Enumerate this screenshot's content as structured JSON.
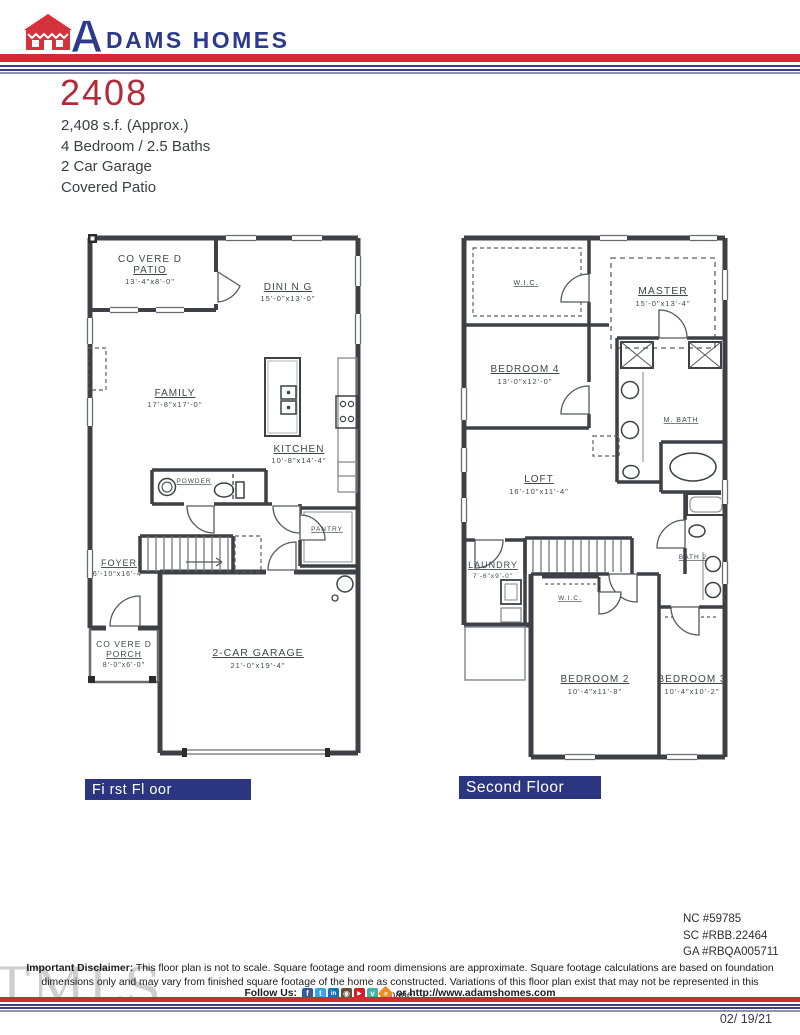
{
  "colors": {
    "accent_red": "#cf2b33",
    "brand_navy": "#2b3a8c",
    "bar_navy": "#2c3680",
    "plan_line": "#3d4145"
  },
  "header": {
    "brand_a": "A",
    "brand_rest": "DAMS HOMES"
  },
  "plan": {
    "number": "2408",
    "specs": [
      "2,408 s.f. (Approx.)",
      "4 Bedroom / 2.5 Baths",
      "2 Car Garage",
      "Covered Patio"
    ]
  },
  "floors": {
    "first": {
      "label": "Fi rst Fl oor",
      "rooms": {
        "patio": {
          "name1": "CO VERE D",
          "name2": "PATIO",
          "dims": "13'-4\"x8'-0\""
        },
        "dining": {
          "name": "DINI N G",
          "dims": "15'-0\"x13'-0\""
        },
        "family": {
          "name": "FAMILY",
          "dims": "17'-8\"x17'-0\""
        },
        "kitchen": {
          "name": "KITCHEN",
          "dims": "10'-8\"x14'-4\""
        },
        "powder": {
          "name": "POWDER"
        },
        "pantry": {
          "name": "PANTRY"
        },
        "foyer": {
          "name": "FOYER",
          "dims": "6'-10\"x16'-4\""
        },
        "porch": {
          "name1": "CO VERE D",
          "name2": "PORCH",
          "dims": "8'-0\"x6'-0\""
        },
        "garage": {
          "name": "2-CAR GARAGE",
          "dims": "21'-0\"x19'-4\""
        }
      }
    },
    "second": {
      "label": "Second Floor",
      "rooms": {
        "wic_master": {
          "name": "W.I.C."
        },
        "master": {
          "name": "MASTER",
          "dims": "15'-0\"x13'-4\""
        },
        "bedroom4": {
          "name": "BEDROOM 4",
          "dims": "13'-0\"x12'-0\""
        },
        "mbath": {
          "name": "M. BATH"
        },
        "loft": {
          "name": "LOFT",
          "dims": "16'-10\"x11'-4\""
        },
        "laundry": {
          "name": "LAUNDRY",
          "dims": "7'-6\"x9'-0\""
        },
        "wic2": {
          "name": "W.I.C."
        },
        "bath2": {
          "name": "BATH 2"
        },
        "bedroom2": {
          "name": "BEDROOM 2",
          "dims": "10'-4\"x11'-8\""
        },
        "bedroom3": {
          "name": "BEDROOM 3",
          "dims": "10'-4\"x10'-2\""
        }
      }
    }
  },
  "footer": {
    "licenses": [
      "NC #59785",
      "SC #RBB.22464",
      "GA #RBQA005711"
    ],
    "disclaimer_bold": "Important Disclaimer:",
    "disclaimer_text": "This floor plan is not to scale. Square footage and room dimensions are approximate. Square footage calculations are based on foundation dimensions only and may vary from finished square footage of the home as constructed. Variations of this floor plan exist that may not be represented in this image.",
    "follow_label": "Follow Us:",
    "follow_suffix": "or http://www.adamshomes.com",
    "social": [
      {
        "name": "facebook",
        "glyph": "f",
        "color": "#3b5998"
      },
      {
        "name": "twitter",
        "glyph": "t",
        "color": "#35a6de"
      },
      {
        "name": "linkedin",
        "glyph": "in",
        "color": "#1178b3"
      },
      {
        "name": "instagram",
        "glyph": "◉",
        "color": "#6a4a3f"
      },
      {
        "name": "youtube",
        "glyph": "▶",
        "color": "#cc2127"
      },
      {
        "name": "vimeo",
        "glyph": "v",
        "color": "#44b3a6"
      },
      {
        "name": "rss",
        "glyph": "»",
        "color": "#f08c21"
      }
    ],
    "date": "02/ 19/21",
    "watermark": "TMLS"
  }
}
